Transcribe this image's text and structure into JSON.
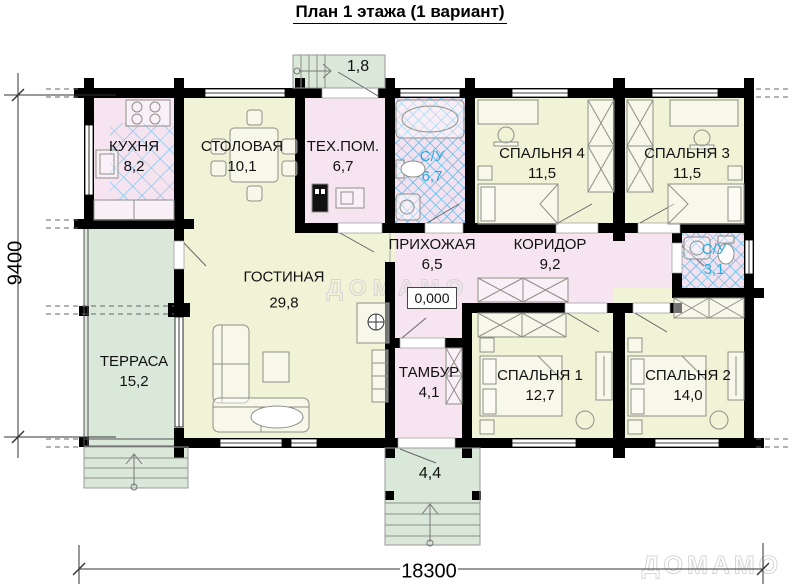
{
  "title": "План 1 этажа (1 вариант)",
  "watermark": {
    "text": "ДОМАМО"
  },
  "elevation": "0,000",
  "dimensions": {
    "width": "18300",
    "height": "9400"
  },
  "porches": {
    "top_area": "1,8",
    "bottom_area": "4,4"
  },
  "rooms": [
    {
      "id": "kitchen",
      "name": "КУХНЯ",
      "area": "8,2"
    },
    {
      "id": "dining",
      "name": "СТОЛОВАЯ",
      "area": "10,1"
    },
    {
      "id": "tech",
      "name": "ТЕХ.ПОМ.",
      "area": "6,7"
    },
    {
      "id": "bath-main",
      "name": "С/У",
      "area": "6,7"
    },
    {
      "id": "bedroom4",
      "name": "СПАЛЬНЯ 4",
      "area": "11,5"
    },
    {
      "id": "bedroom3",
      "name": "СПАЛЬНЯ 3",
      "area": "11,5"
    },
    {
      "id": "hallway",
      "name": "ПРИХОЖАЯ",
      "area": "6,5"
    },
    {
      "id": "corridor",
      "name": "КОРИДОР",
      "area": "9,2"
    },
    {
      "id": "bath-small",
      "name": "С/У",
      "area": "3,1"
    },
    {
      "id": "living",
      "name": "ГОСТИНАЯ",
      "area": "29,8"
    },
    {
      "id": "terrace",
      "name": "ТЕРРАСА",
      "area": "15,2"
    },
    {
      "id": "vestibule",
      "name": "ТАМБУР",
      "area": "4,1"
    },
    {
      "id": "bedroom1",
      "name": "СПАЛЬНЯ 1",
      "area": "12,7"
    },
    {
      "id": "bedroom2",
      "name": "СПАЛЬНЯ 2",
      "area": "14,0"
    }
  ],
  "colors": {
    "wall": "#000000",
    "room_pink": "#f6e4f0",
    "room_yellow": "#f1f3d7",
    "terrace_green": "#d9e8d9",
    "bath_hatch_blue": "#58beeb",
    "bath_label_blue": "#2aa9e1",
    "furniture_line": "#8f8f88",
    "watermark_gray": "#d5d5d5"
  }
}
